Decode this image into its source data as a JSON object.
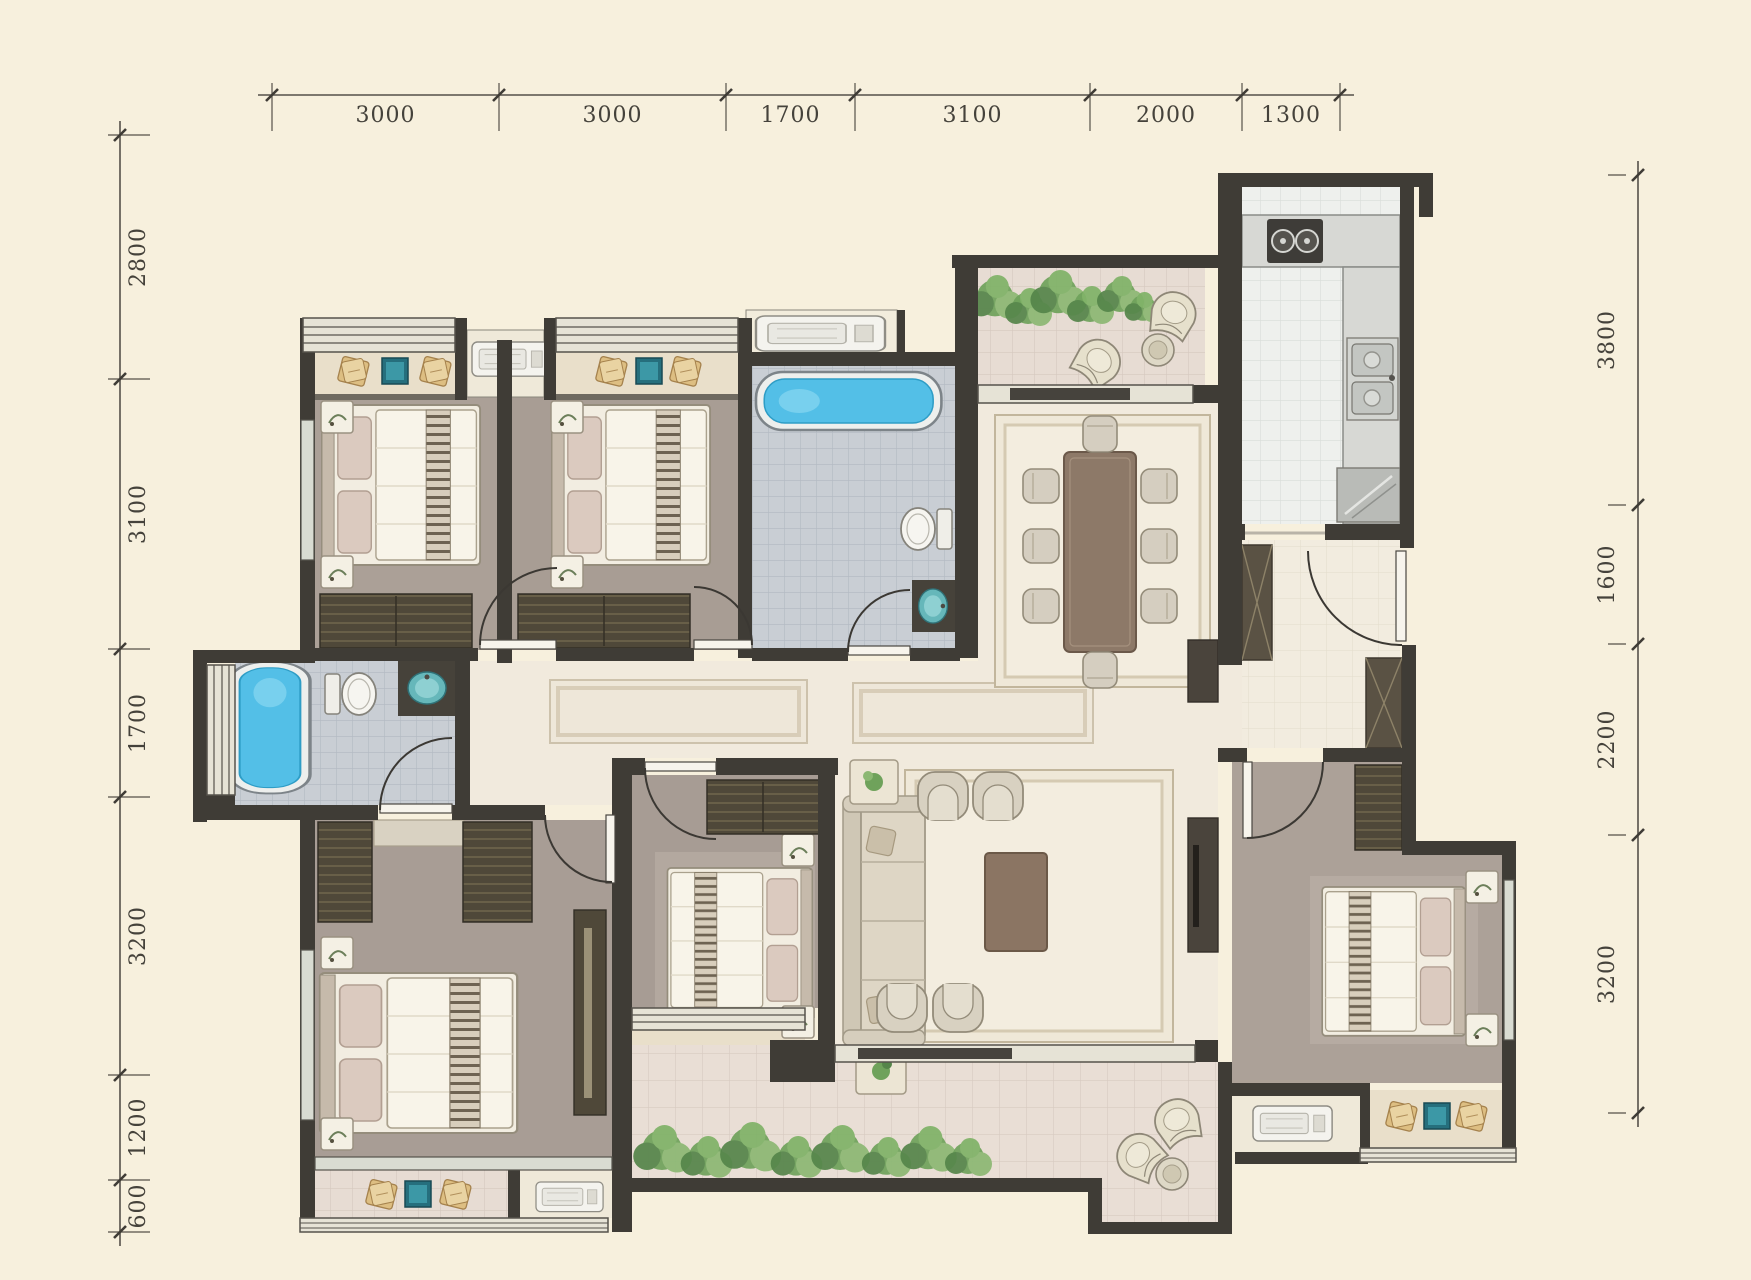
{
  "canvas": {
    "width": 1751,
    "height": 1280,
    "background": "#f7f0dd"
  },
  "dimensions": {
    "unit": "mm",
    "top": {
      "labels": [
        "3000",
        "3000",
        "1700",
        "3100",
        "2000",
        "1300"
      ]
    },
    "left": {
      "labels": [
        "2800",
        "3100",
        "1700",
        "3200",
        "1200",
        "600"
      ]
    },
    "right": {
      "labels": [
        "3800",
        "1600",
        "2200",
        "3200"
      ]
    }
  },
  "colors": {
    "background": "#f7f0dd",
    "wall": "#3f3c36",
    "open_floor": "#f1eadd",
    "bedroom_floor": "#a99e95",
    "bathroom_floor": "#c9ced4",
    "kitchen_floor": "#eef0ed",
    "balcony_floor": "#e7dcd3",
    "bay_floor": "#e9dfca",
    "rug": "#efe8d8",
    "water_blue": "#53bfe7",
    "fixture_teal": "#66b7ba",
    "plant_green": "#6fa25b",
    "wood_brown": "#8d7968",
    "wardrobe_dark": "#4f4839",
    "pillow_gold": "#ddbe82",
    "dimension_text": "#45423b"
  }
}
